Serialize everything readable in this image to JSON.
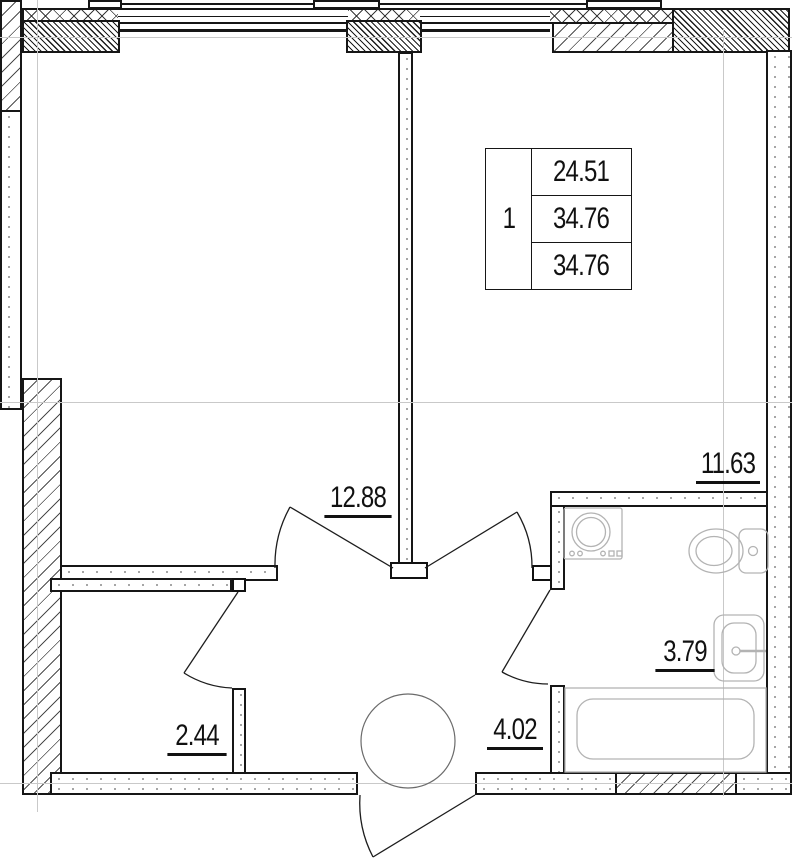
{
  "document": {
    "type": "apartment-floor-plan"
  },
  "info_table": {
    "unit_number": "1",
    "values": [
      "24.51",
      "34.76",
      "34.76"
    ]
  },
  "rooms": [
    {
      "name": "living-room",
      "area": "12.88"
    },
    {
      "name": "kitchen",
      "area": "11.63"
    },
    {
      "name": "storage",
      "area": "2.44"
    },
    {
      "name": "hallway",
      "area": "4.02"
    },
    {
      "name": "bathroom",
      "area": "3.79"
    }
  ],
  "colors": {
    "wall": "#161616",
    "fixtures": "#b3b3b3",
    "axis": "#c9c9c9",
    "text": "#111111"
  }
}
